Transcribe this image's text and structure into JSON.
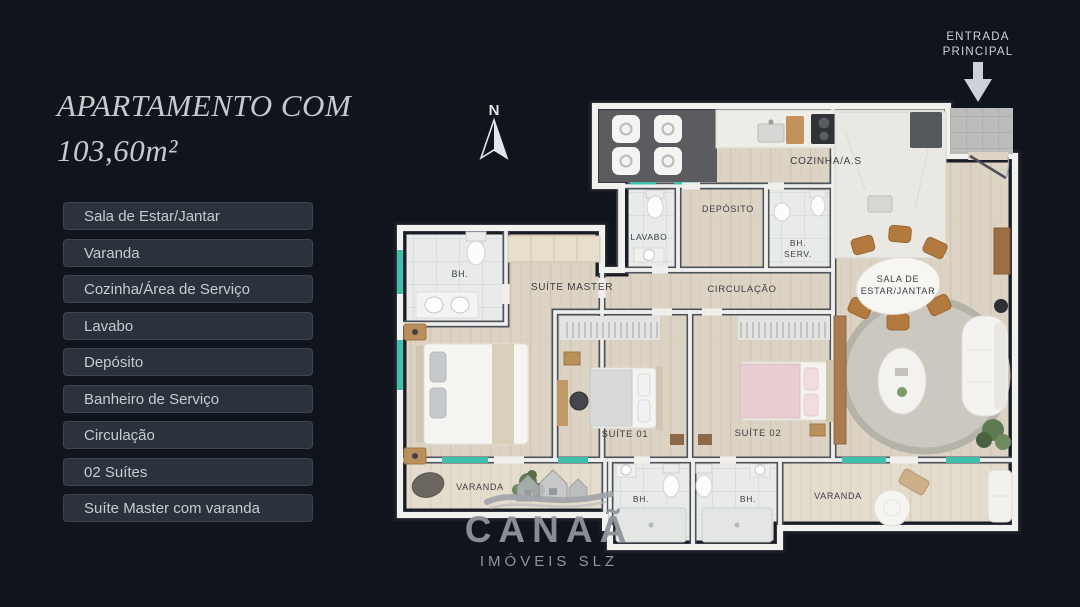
{
  "title": {
    "line1": "APARTAMENTO COM",
    "line2": "103,60m²"
  },
  "features": [
    "Sala de Estar/Jantar",
    "Varanda",
    "Cozinha/Área de Serviço",
    "Lavabo",
    "Depósito",
    "Banheiro de Serviço",
    "Circulação",
    "02 Suítes",
    "Suíte Master com varanda"
  ],
  "entrance": {
    "line1": "ENTRADA",
    "line2": "PRINCIPAL"
  },
  "compass": {
    "north": "N"
  },
  "rooms": {
    "cozinha": "COZINHA/A.S",
    "lavabo": "LAVABO",
    "deposito": "DEPÓSITO",
    "bh_serv_1": "BH.",
    "bh_serv_2": "SERV.",
    "circulacao": "CIRCULAÇÃO",
    "sala_1": "SALA DE",
    "sala_2": "ESTAR/JANTAR",
    "suite_master": "SUÍTE MASTER",
    "bh_master": "BH.",
    "suite_01": "SUÍTE 01",
    "suite_02": "SUÍTE 02",
    "varanda_master": "VARANDA",
    "bh_1": "BH.",
    "bh_2": "BH.",
    "varanda_sala": "VARANDA"
  },
  "logo": {
    "name": "CANAÃ",
    "subtitle": "IMÓVEIS SLZ"
  },
  "colors": {
    "background": "#10141d",
    "chip_bg": "#2c323c",
    "chip_text": "#c6cbd1",
    "title_text": "#c9c8cb",
    "floor_wood": "#dcd3c4",
    "wall_white": "#eff0ee",
    "wall_dark": "#4d5159",
    "window_teal": "#3fc0ac",
    "logo_gray": "#8f939a"
  }
}
